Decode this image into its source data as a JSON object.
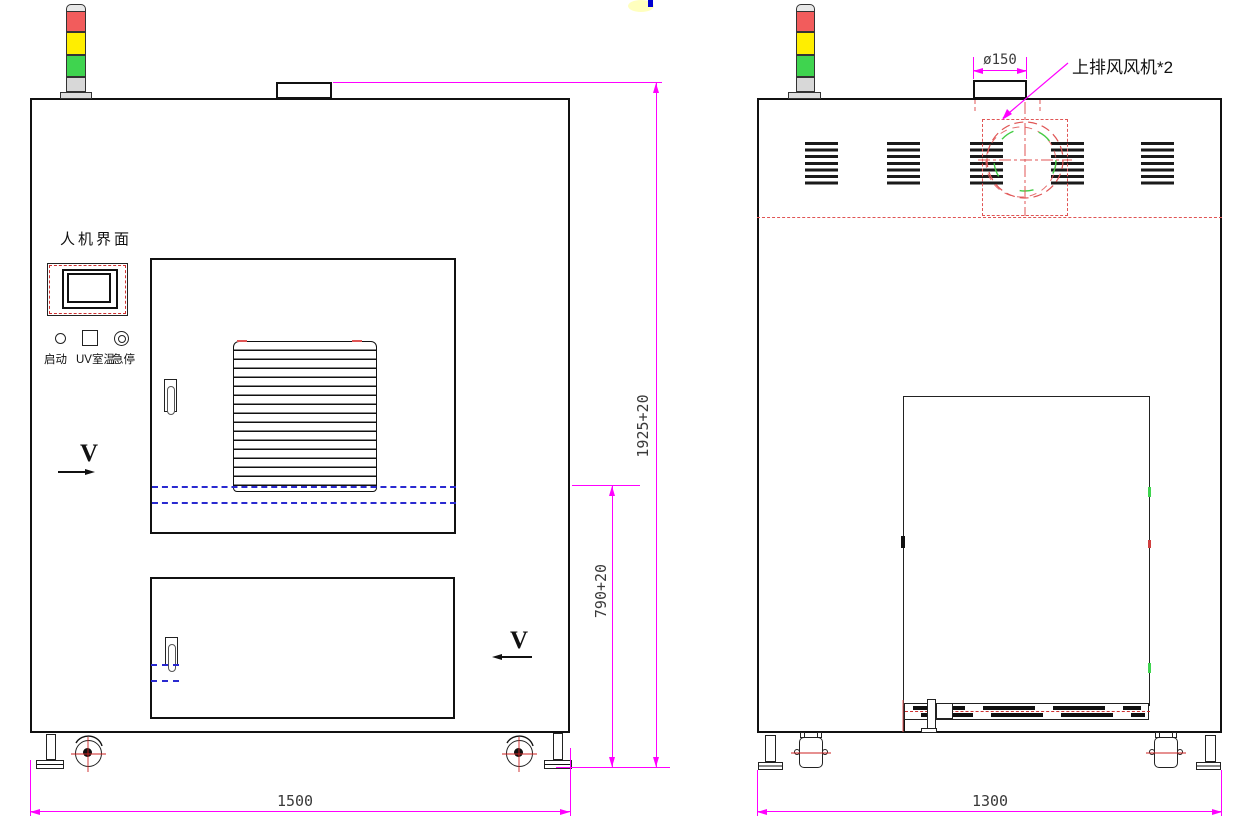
{
  "front_view": {
    "hmi_label": "人机界面",
    "button_start": "启动",
    "button_uv": "UV室温",
    "button_estop": "急停",
    "section_marker_left": "V",
    "section_marker_right": "V",
    "dim_width": "1500",
    "dim_total_height": "1925+20",
    "dim_work_height": "790+20"
  },
  "rear_view": {
    "dim_width": "1300",
    "dim_duct_diameter": "ø150",
    "fan_callout": "上排风风机*2"
  },
  "colors": {
    "dimension_magenta": "#ff00ff",
    "centerline_red": "#e05555",
    "hidden_line_blue": "#2a2ad0",
    "tower_red": "#f25c5c",
    "tower_yellow": "#ffee00",
    "tower_green": "#3fd44f"
  }
}
